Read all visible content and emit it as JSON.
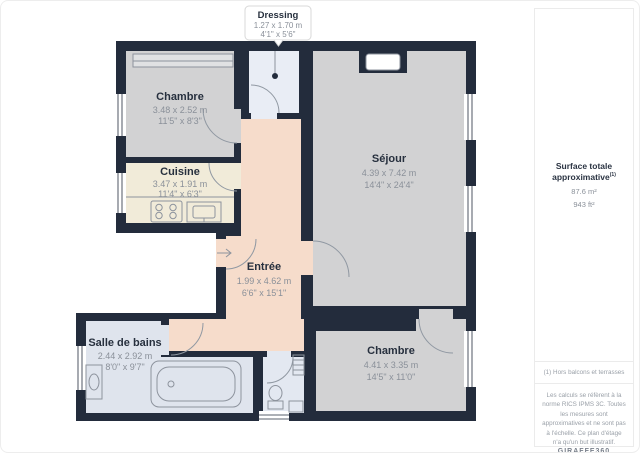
{
  "callout": {
    "title": "Dressing",
    "dim_m": "1.27 x 1.70 m",
    "dim_ft": "4'1\" x 5'6\""
  },
  "rooms": {
    "chambre_tl": {
      "name": "Chambre",
      "dim_m": "3.48 x 2.52 m",
      "dim_ft": "11'5\" x 8'3\""
    },
    "cuisine": {
      "name": "Cuisine",
      "dim_m": "3.47 x 1.91 m",
      "dim_ft": "11'4\" x 6'3\""
    },
    "sejour": {
      "name": "Séjour",
      "dim_m": "4.39 x 7.42 m",
      "dim_ft": "14'4\" x 24'4\""
    },
    "entree": {
      "name": "Entrée",
      "dim_m": "1.99 x 4.62 m",
      "dim_ft": "6'6\" x 15'1\""
    },
    "salle_de_bains": {
      "name": "Salle de bains",
      "dim_m": "2.44 x 2.92 m",
      "dim_ft": "8'0\" x 9'7\""
    },
    "chambre_br": {
      "name": "Chambre",
      "dim_m": "4.41 x 3.35 m",
      "dim_ft": "14'5\" x 11'0\""
    }
  },
  "sidebar": {
    "surface_title": "Surface totale approximative",
    "surface_sup": "(1)",
    "surface_m2": "87.6 m²",
    "surface_ft2": "943 ft²",
    "footnote": "(1) Hors balcons et terrasses",
    "disclaimer": "Les calculs se réfèrent à la norme RICS IPMS 3C. Toutes les mesures sont approximatives et ne sont pas à l'échelle. Ce plan d'étage n'a qu'un but illustratif.",
    "logo": "GIRAFFE360"
  },
  "colors": {
    "wall": "#232c3c",
    "room_gray": "#d2d2d3",
    "cuisine": "#f1ebd9",
    "entree": "#f6dccb",
    "dressing": "#e9edf5",
    "bath": "#dfe4ed",
    "wc": "#e3e8f1"
  }
}
